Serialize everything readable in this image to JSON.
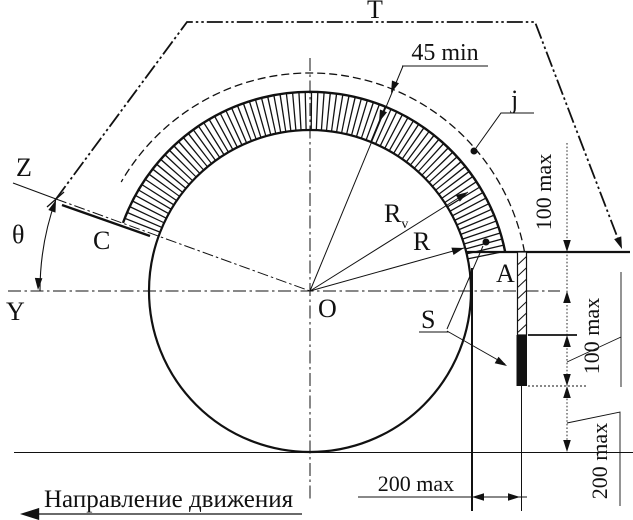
{
  "colors": {
    "ink": "#111111",
    "paper": "#ffffff"
  },
  "labels": {
    "top_plane": "T",
    "z_axis": "Z",
    "theta": "θ",
    "y_axis": "Y",
    "point_c": "C",
    "center": "O",
    "point_a": "A",
    "flap": "S",
    "clearance": "j",
    "radius": "R",
    "outer_radius_base": "R",
    "outer_radius_sub": "v",
    "depth_min": "45 min"
  },
  "dimensions": {
    "upper_right": "100 max",
    "middle_right": "100 max",
    "lower_right": "200 max",
    "bottom": "200 max"
  },
  "caption": {
    "direction": "Направление движения"
  }
}
